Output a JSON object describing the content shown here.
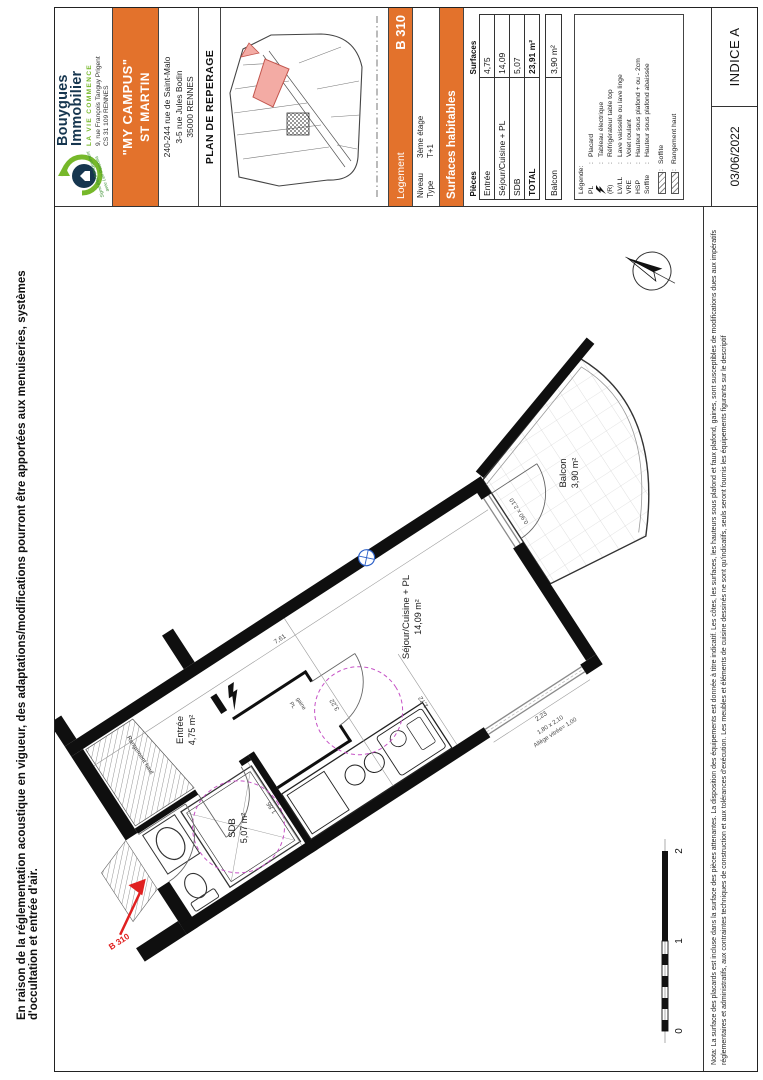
{
  "notes": {
    "acoustic": "En raison de la réglementation acoustique en vigueur, des adaptations/modifications pourront être apportées aux menuiseries, systèmes d'occultation et entrée d'air.",
    "nota_line1": "Nota: La surface des placards est incluse dans la surface des pièces attenantes. La disposition des équipements est donnée à titre indicatif. Les côtes, les surfaces, les hauteurs sous plafond et faux plafond, gaines, sont susceptibles de modifications dues aux impératifs",
    "nota_line2": "réglementaires et administratifs, aux contraintes techniques de construction et aux tolérances d'exécution. Les meubles et éléments de cuisine dessinés ne sont qu'indicatifs, seuls seront fournis les équipements figurants sur le descriptif"
  },
  "title_block": {
    "logo": {
      "brand_line1": "Bouygues",
      "brand_line2": "Immobilier",
      "tagline": "LA VIE COMMENCE",
      "address_line1": "9, rue François Tanguy Prigent",
      "address_line2": "CS 31 109 RENNES",
      "stamp_line1": "Signé électroniquement",
      "stamp_line2": "avec Lex Persona"
    },
    "project": {
      "name_line1": "\"MY CAMPUS\"",
      "name_line2": "ST MARTIN",
      "address_line1": "240-244 rue de Saint-Malo",
      "address_line2": "3-5 rue Jules Bodin",
      "address_line3": "35000 RENNES"
    },
    "plan_title": "PLAN DE REPERAGE",
    "logement": {
      "label": "Logement",
      "unit": "B 310",
      "niveau_label": "Niveau",
      "niveau_value": "3ème étage",
      "type_label": "Type",
      "type_value": "T+1"
    },
    "surfaces": {
      "banner": "Surfaces habitables",
      "col_pieces": "Pièces",
      "col_surfaces": "Surfaces",
      "rows": [
        {
          "label": "Entrée",
          "value": "4,75"
        },
        {
          "label": "Séjour/Cuisine + PL",
          "value": "14,09"
        },
        {
          "label": "SDB",
          "value": "5,07"
        }
      ],
      "total_label": "TOTAL",
      "total_value": "23,91 m²",
      "balcon_label": "Balcon",
      "balcon_value": "3,90 m²"
    },
    "legend": {
      "title": "Légende:",
      "sep": ":",
      "rows": [
        {
          "abbr": "PL",
          "desc": "Placard"
        },
        {
          "abbr": "",
          "desc": "Tableau électrique"
        },
        {
          "abbr": "(R)",
          "desc": "Réfrigérateur table top"
        },
        {
          "abbr": "LV/LL",
          "desc": "Lave vaisselle ou lave linge"
        },
        {
          "abbr": "VRE",
          "desc": "Volet roulant"
        },
        {
          "abbr": "HSP",
          "desc": "Hauteur sous plafond + ou - 2cm"
        },
        {
          "abbr": "Soffite",
          "desc": "Hauteur sous plafond abaissée"
        }
      ],
      "swatches": [
        {
          "desc": "Soffite"
        },
        {
          "desc": "Rangement haut"
        }
      ]
    },
    "revision": {
      "date": "03/06/2022",
      "indice": "INDICE A"
    }
  },
  "plan": {
    "unit_label": "B 310",
    "rooms": {
      "entree": {
        "name": "Entrée",
        "area": "4,75 m²"
      },
      "sejour": {
        "name": "Séjour/Cuisine + PL",
        "area": "14,09 m²"
      },
      "sdb": {
        "name": "SDB",
        "area": "5,07 m²"
      },
      "balcon": {
        "name": "Balcon",
        "area": "3,90 m²"
      }
    },
    "annotations": {
      "rangement": "Rangement haut",
      "closet_line1": "PL",
      "closet_line2": "gaine"
    },
    "dims": {
      "d761": "7,61",
      "d322": "3,22",
      "d172": "1,72",
      "d186": "1,86",
      "d223": "2,23"
    },
    "windows": {
      "balcony_door": "0,90 x 2,10",
      "bay": "1,80 x 2,10",
      "allege": "Allège vitrée= 1,00"
    },
    "scale": {
      "t0": "0",
      "t1": "1",
      "t2": "2"
    }
  },
  "colors": {
    "orange": "#e3722c",
    "wall_black": "#0f0f0f",
    "pink_unit": "#f3aba4",
    "magenta_dashed": "#c653c6",
    "red_marker": "#e02020",
    "navy_brand": "#16364f",
    "green_brand": "#76b82a",
    "blue_symbol": "#2e62c9"
  }
}
